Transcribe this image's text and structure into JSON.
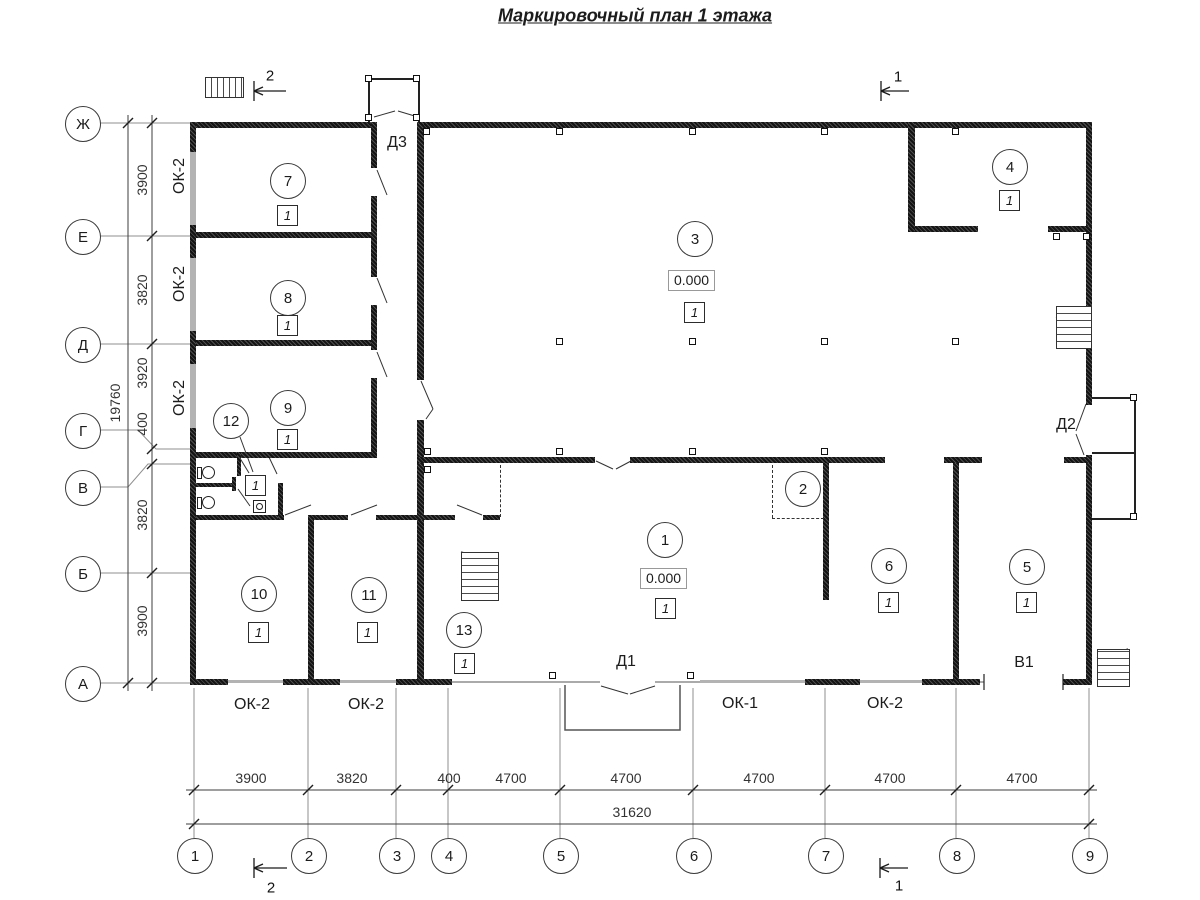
{
  "title": "Маркировочный план 1 этажа",
  "axes": {
    "left": [
      "Ж",
      "Е",
      "Д",
      "Г",
      "В",
      "Б",
      "А"
    ],
    "bottom": [
      "1",
      "2",
      "3",
      "4",
      "5",
      "6",
      "7",
      "8",
      "9"
    ]
  },
  "dims": {
    "left": [
      "3900",
      "3820",
      "3920",
      "400",
      "3820",
      "3900"
    ],
    "left_total": "19760",
    "bottom": [
      "3900",
      "3820",
      "400",
      "4700",
      "4700",
      "4700",
      "4700",
      "4700"
    ],
    "bottom_total": "31620"
  },
  "windows": {
    "ok1": "ОК-1",
    "ok2": "ОК-2"
  },
  "doors": {
    "d1": "Д1",
    "d2": "Д2",
    "d3": "Д3",
    "v1": "В1"
  },
  "sections": {
    "s1": "1",
    "s2": "2"
  },
  "elevation": "0.000",
  "category": "1",
  "rooms": {
    "r1": "1",
    "r2": "2",
    "r3": "3",
    "r4": "4",
    "r5": "5",
    "r6": "6",
    "r7": "7",
    "r8": "8",
    "r9": "9",
    "r10": "10",
    "r11": "11",
    "r12": "12",
    "r13": "13"
  }
}
